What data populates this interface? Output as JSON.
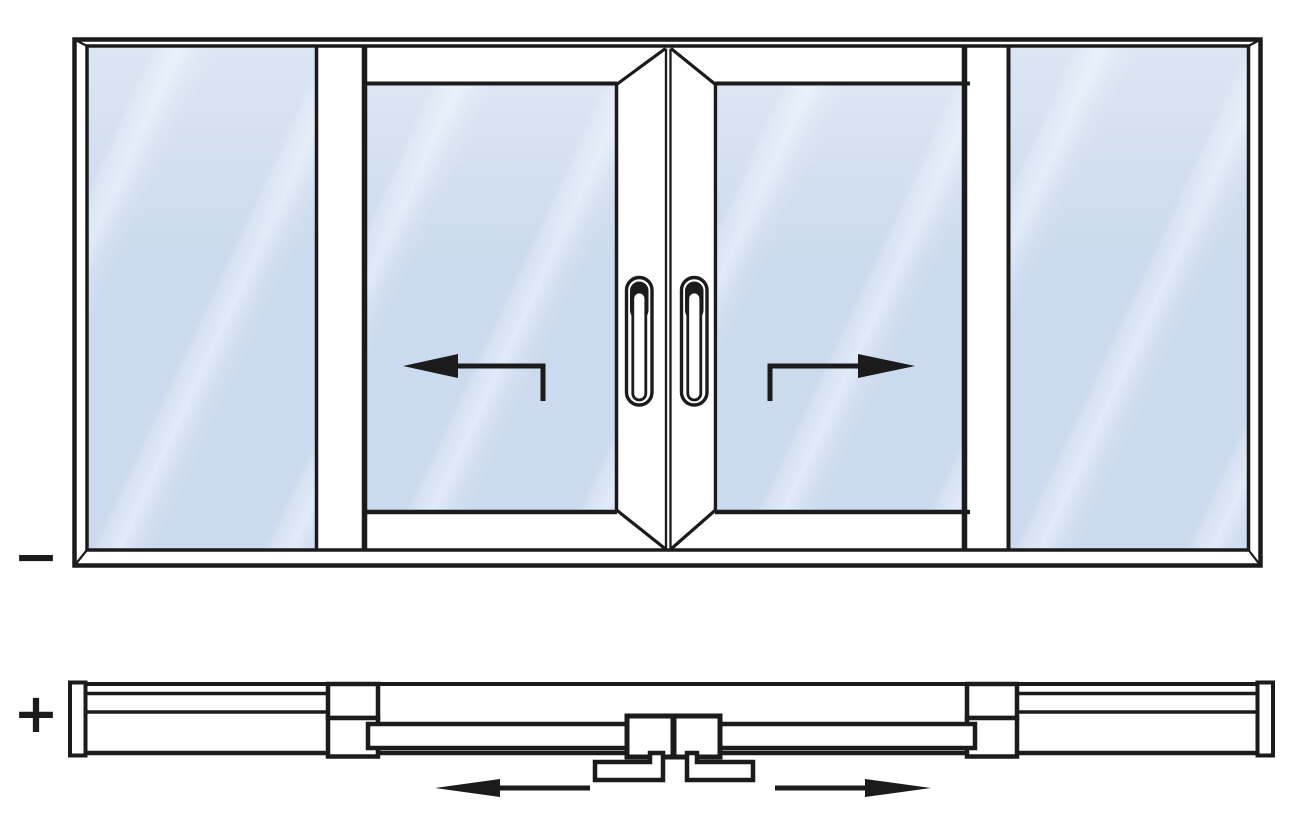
{
  "diagram": {
    "type": "sliding-door-elevation-and-plan",
    "labels": {
      "minus": "−",
      "plus": "+"
    },
    "colors": {
      "line": "#1b1b1b",
      "glass_fill": "#cbdaee",
      "glass_highlight": "#e0eaf8",
      "background": "#ffffff"
    },
    "icons": {
      "slide_left_arrow": "←",
      "slide_right_arrow": "→",
      "plan_slide_left_arrow": "←",
      "plan_slide_right_arrow": "→"
    }
  }
}
